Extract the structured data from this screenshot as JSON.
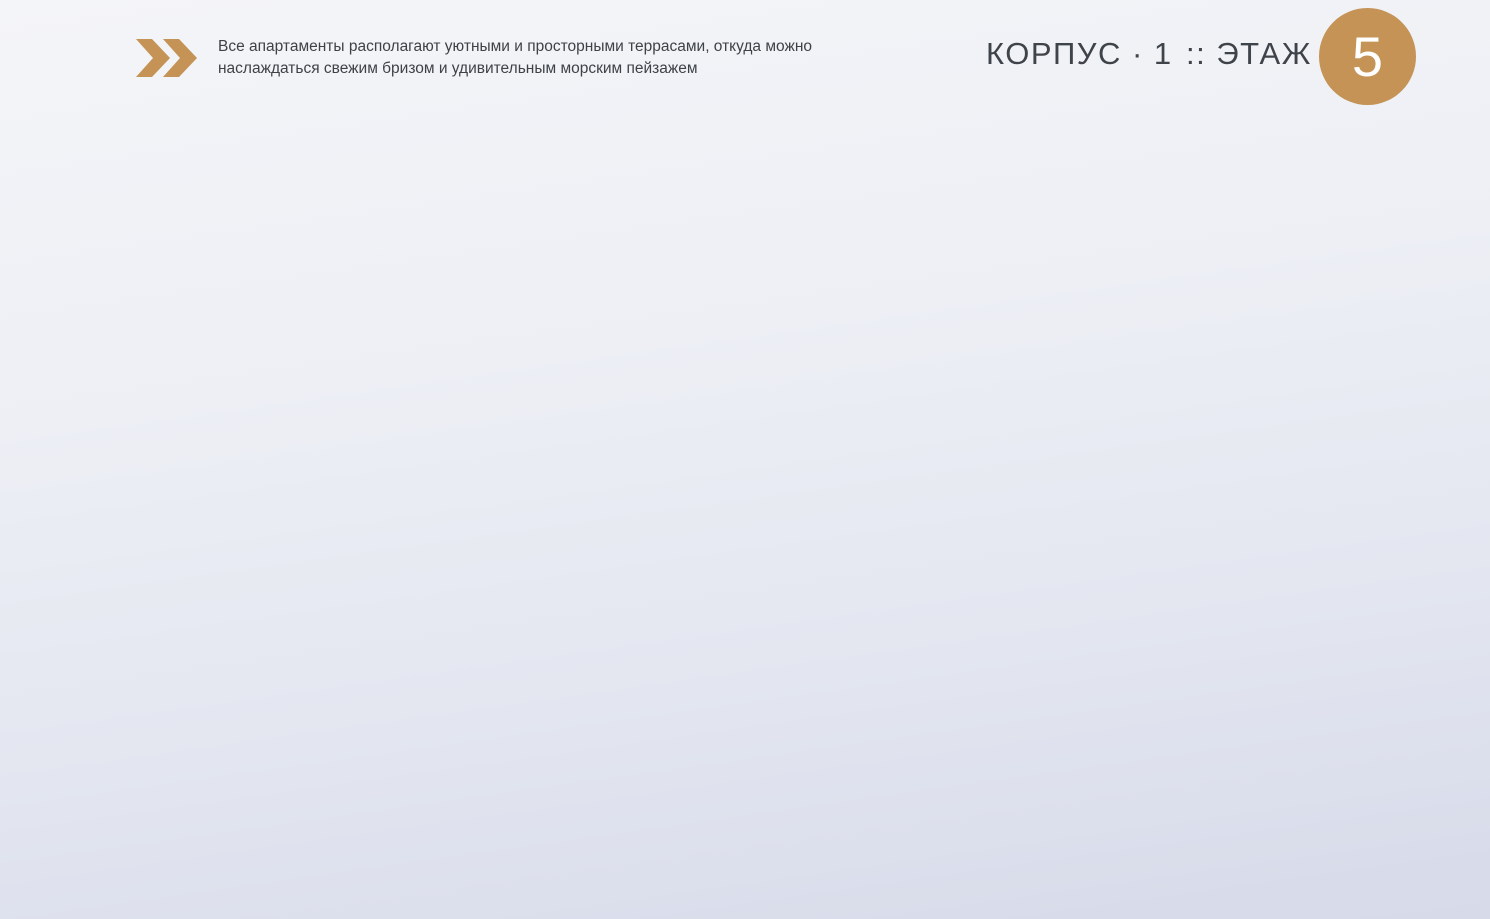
{
  "header": {
    "tagline_line1": "Все апартаменты располагают уютными и просторными террасами, откуда можно",
    "tagline_line2": "наслаждаться свежим бризом и удивительным морским пейзажем",
    "building_label": "КОРПУС · 1",
    "floor_prefix": ":: ЭТАЖ",
    "floor_number": "5",
    "chevrons_icon": "double-chevron-right-icon"
  },
  "colors": {
    "gold": "#c49355",
    "beige": "#eae0c2",
    "teal": "#abdad2",
    "orange": "#fbd98e",
    "green": "#b7dba3",
    "pink": "#f2b6b2",
    "wall": "#6f6f60",
    "halo": "#f4f5f9",
    "leader": "#8aa0cb",
    "label_name": "#585e66",
    "label_area": "#8f959f"
  },
  "apartments": [
    {
      "id": "b40",
      "name": "Ап. KI Б40",
      "area": "89,00 м²",
      "color": "beige",
      "waves": false,
      "label": {
        "x": 407,
        "y": 133
      },
      "leader": [
        [
          351,
          155
        ],
        [
          323,
          155
        ],
        [
          323,
          271
        ]
      ],
      "polygon": "283,241 420,194 522,207 566,228 562,313 521,319 539,360 478,401 432,364 262,313"
    },
    {
      "id": "b39",
      "name": "Ап. KI Б39",
      "area": "65,01 м²",
      "color": "teal",
      "waves": false,
      "label": {
        "x": 100,
        "y": 325
      },
      "leader": [
        [
          148,
          349
        ],
        [
          303,
          349
        ]
      ],
      "polygon": "262,313 432,364 455,400 438,468 415,478 330,492 250,448 222,370"
    },
    {
      "id": "b38",
      "name": "Ап. KI Б38",
      "area": "63,47 м²",
      "color": "orange",
      "waves": false,
      "label": {
        "x": 103,
        "y": 473
      },
      "leader": [
        [
          148,
          495
        ],
        [
          258,
          495
        ]
      ],
      "polygon": "213,440 250,448 330,492 415,478 433,472 428,522 390,556 300,560 296,600 207,594 193,515"
    },
    {
      "id": "b37",
      "name": "Ап. KI Б37",
      "area": "89,33 м²",
      "color": "green",
      "waves": false,
      "label": {
        "x": 98,
        "y": 620
      },
      "leader": [
        [
          148,
          642
        ],
        [
          242,
          642
        ]
      ],
      "polygon": "207,594 296,600 300,560 390,556 433,528 452,562 428,597 362,716 398,741 373,772 300,792 268,787 172,762 162,690 196,652 188,600"
    },
    {
      "id": "b36",
      "name": "Ап. KI Б36",
      "area": "63,95 м²",
      "color": "orange",
      "waves": false,
      "label": {
        "x": 267,
        "y": 840
      },
      "leader": [
        [
          317,
          863
        ],
        [
          346,
          863
        ],
        [
          381,
          708
        ]
      ],
      "polygon": "428,597 452,562 480,572 500,592 496,650 468,700 430,728 448,762 412,795 378,768 398,741 362,716"
    },
    {
      "id": "b35",
      "name": "Ап. KI Б35",
      "area": "73,25 м²",
      "color": "teal",
      "waves": false,
      "label": {
        "x": 430,
        "y": 840
      },
      "leader": [
        [
          480,
          863
        ],
        [
          508,
          863
        ],
        [
          531,
          731
        ]
      ],
      "polygon": "500,592 556,606 600,614 628,645 628,702 600,748 560,795 515,815 468,798 470,740 468,700 496,650"
    },
    {
      "id": "b34",
      "name": "Ап. KI Б34",
      "area": "60,85 м²",
      "color": "beige",
      "waves": false,
      "label": {
        "x": 600,
        "y": 840
      },
      "leader": [
        [
          643,
          863
        ],
        [
          671,
          863
        ],
        [
          671,
          677
        ]
      ],
      "polygon": "630,512 710,510 710,833 686,861 643,858 610,840 600,748 628,702 628,560"
    },
    {
      "id": "a23",
      "name": "Ап. KI А23",
      "area": "60,85 м²",
      "color": "beige",
      "waves": true,
      "label": {
        "x": 832,
        "y": 840
      },
      "leader": [
        [
          777,
          872
        ],
        [
          755,
          872
        ],
        [
          755,
          677
        ]
      ],
      "polygon": "710,510 787,513 790,560 790,702 818,748 808,840 775,858 732,861 710,833"
    },
    {
      "id": "a24",
      "name": "Ап. KI А24",
      "area": "73,34 м²",
      "color": "teal",
      "waves": true,
      "label": {
        "x": 994,
        "y": 842
      },
      "leader": [
        [
          941,
          884
        ],
        [
          898,
          688
        ]
      ],
      "polygon": "790,560 922,562 922,650 905,705 912,762 868,802 820,820 808,840 818,748 790,702"
    },
    {
      "id": "a25",
      "name": "Ап. KI А25",
      "area": "70,21 м²",
      "color": "orange",
      "waves": true,
      "label": {
        "x": 1158,
        "y": 841
      },
      "leader": [
        [
          1105,
          886
        ],
        [
          1046,
          720
        ]
      ],
      "polygon": "922,562 1008,548 1062,565 1062,700 1048,760 1000,790 952,788 918,768 912,762 905,705 922,650"
    },
    {
      "id": "a26",
      "name": "Ап. KI А26",
      "area": "61,17 м²",
      "color": "green",
      "waves": true,
      "label": {
        "x": 1348,
        "y": 838
      },
      "leader": [
        [
          1297,
          884
        ],
        [
          1110,
          657
        ]
      ],
      "polygon": "1062,565 1143,548 1222,705 1150,770 1085,787 1048,760 1062,700"
    },
    {
      "id": "a27",
      "name": "Ап. KI А27",
      "area": "61,17 м²",
      "color": "green",
      "waves": true,
      "label": {
        "x": 1428,
        "y": 620
      },
      "leader": [
        [
          1373,
          642
        ],
        [
          1255,
          642
        ]
      ],
      "polygon": "1140,545 1285,570 1303,605 1268,660 1222,708"
    },
    {
      "id": "a28",
      "name": "Ап. KI А28",
      "area": "70,01 м²",
      "color": "orange",
      "waves": true,
      "label": {
        "x": 1428,
        "y": 473
      },
      "leader": [
        [
          1375,
          495
        ],
        [
          1290,
          498
        ]
      ],
      "polygon": "1105,462 1305,440 1312,520 1285,572 1140,545 1120,518"
    },
    {
      "id": "a29",
      "name": "Ап. KI А29",
      "area": "76,74 м²",
      "color": "teal",
      "waves": true,
      "label": {
        "x": 1428,
        "y": 327
      },
      "leader": [
        [
          1377,
          350
        ],
        [
          1308,
          352
        ]
      ],
      "polygon": "1085,332 1288,264 1345,330 1358,398 1305,440 1105,462 1078,400"
    },
    {
      "id": "a30",
      "name": "Ап. KI А30",
      "area": "88,54 м²",
      "color": "beige",
      "waves": false,
      "label": {
        "x": 922,
        "y": 133
      },
      "leader": [
        [
          975,
          154
        ],
        [
          1167,
          238
        ]
      ],
      "polygon": "1060,155 1102,142 1162,148 1256,212 1295,260 1085,332 1056,300 1075,250 1056,200"
    }
  ],
  "plan": {
    "photo_polygon": "487,222 1047,165 1062,182 1056,302 1088,330 1102,458 1035,492 1000,525 928,558 790,554 787,512 710,509 633,512 632,550 612,430 566,314 552,270",
    "cores": [
      {
        "id": "core-left",
        "polygon": "478,402 521,318 562,314 610,360 638,440 632,555 560,614 500,592 455,520 438,468 455,400"
      },
      {
        "id": "core-right",
        "polygon": "1056,302 1088,330 1108,460 1136,455 1140,520 1062,567 1008,602 950,600 943,548 1000,525 1038,432 1048,380"
      },
      {
        "id": "corridor",
        "polygon": "632,556 787,552 1010,545 1010,600 633,606"
      }
    ],
    "stairs": [
      {
        "x": 492,
        "y": 498,
        "rot": 38,
        "n": 8,
        "step": 9,
        "len": 44
      },
      {
        "x": 1035,
        "y": 468,
        "rot": 126,
        "n": 8,
        "step": 9,
        "len": 44
      }
    ],
    "elevators": [
      {
        "x": 455,
        "y": 402,
        "w": 60,
        "h": 55,
        "rot": 17
      },
      {
        "x": 1058,
        "y": 415,
        "w": 56,
        "h": 48,
        "rot": 5
      }
    ]
  }
}
